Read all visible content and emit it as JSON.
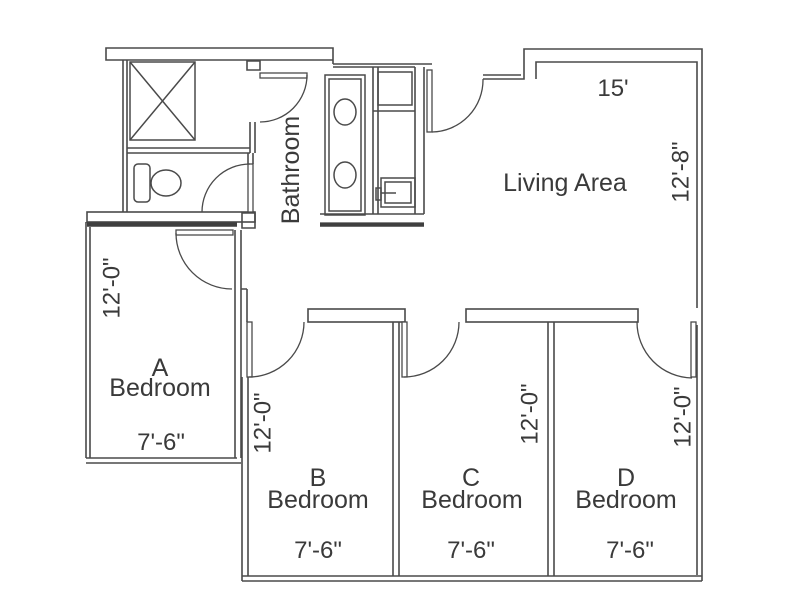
{
  "rooms": {
    "bathroom": {
      "name": "Bathroom"
    },
    "living_area": {
      "name": "Living Area",
      "width": "15'",
      "depth": "12'-8\""
    },
    "bedroom_a": {
      "letter": "A",
      "name": "Bedroom",
      "width": "7'-6\"",
      "depth": "12'-0\""
    },
    "bedroom_b": {
      "letter": "B",
      "name": "Bedroom",
      "width": "7'-6\"",
      "depth": "12'-0\""
    },
    "bedroom_c": {
      "letter": "C",
      "name": "Bedroom",
      "width": "7'-6\"",
      "depth": "12'-0\""
    },
    "bedroom_d": {
      "letter": "D",
      "name": "Bedroom",
      "width": "7'-6\"",
      "depth": "12'-0\""
    }
  },
  "colors": {
    "line": "#4a4a4a",
    "text": "#3a3a3a",
    "background": "#ffffff"
  }
}
